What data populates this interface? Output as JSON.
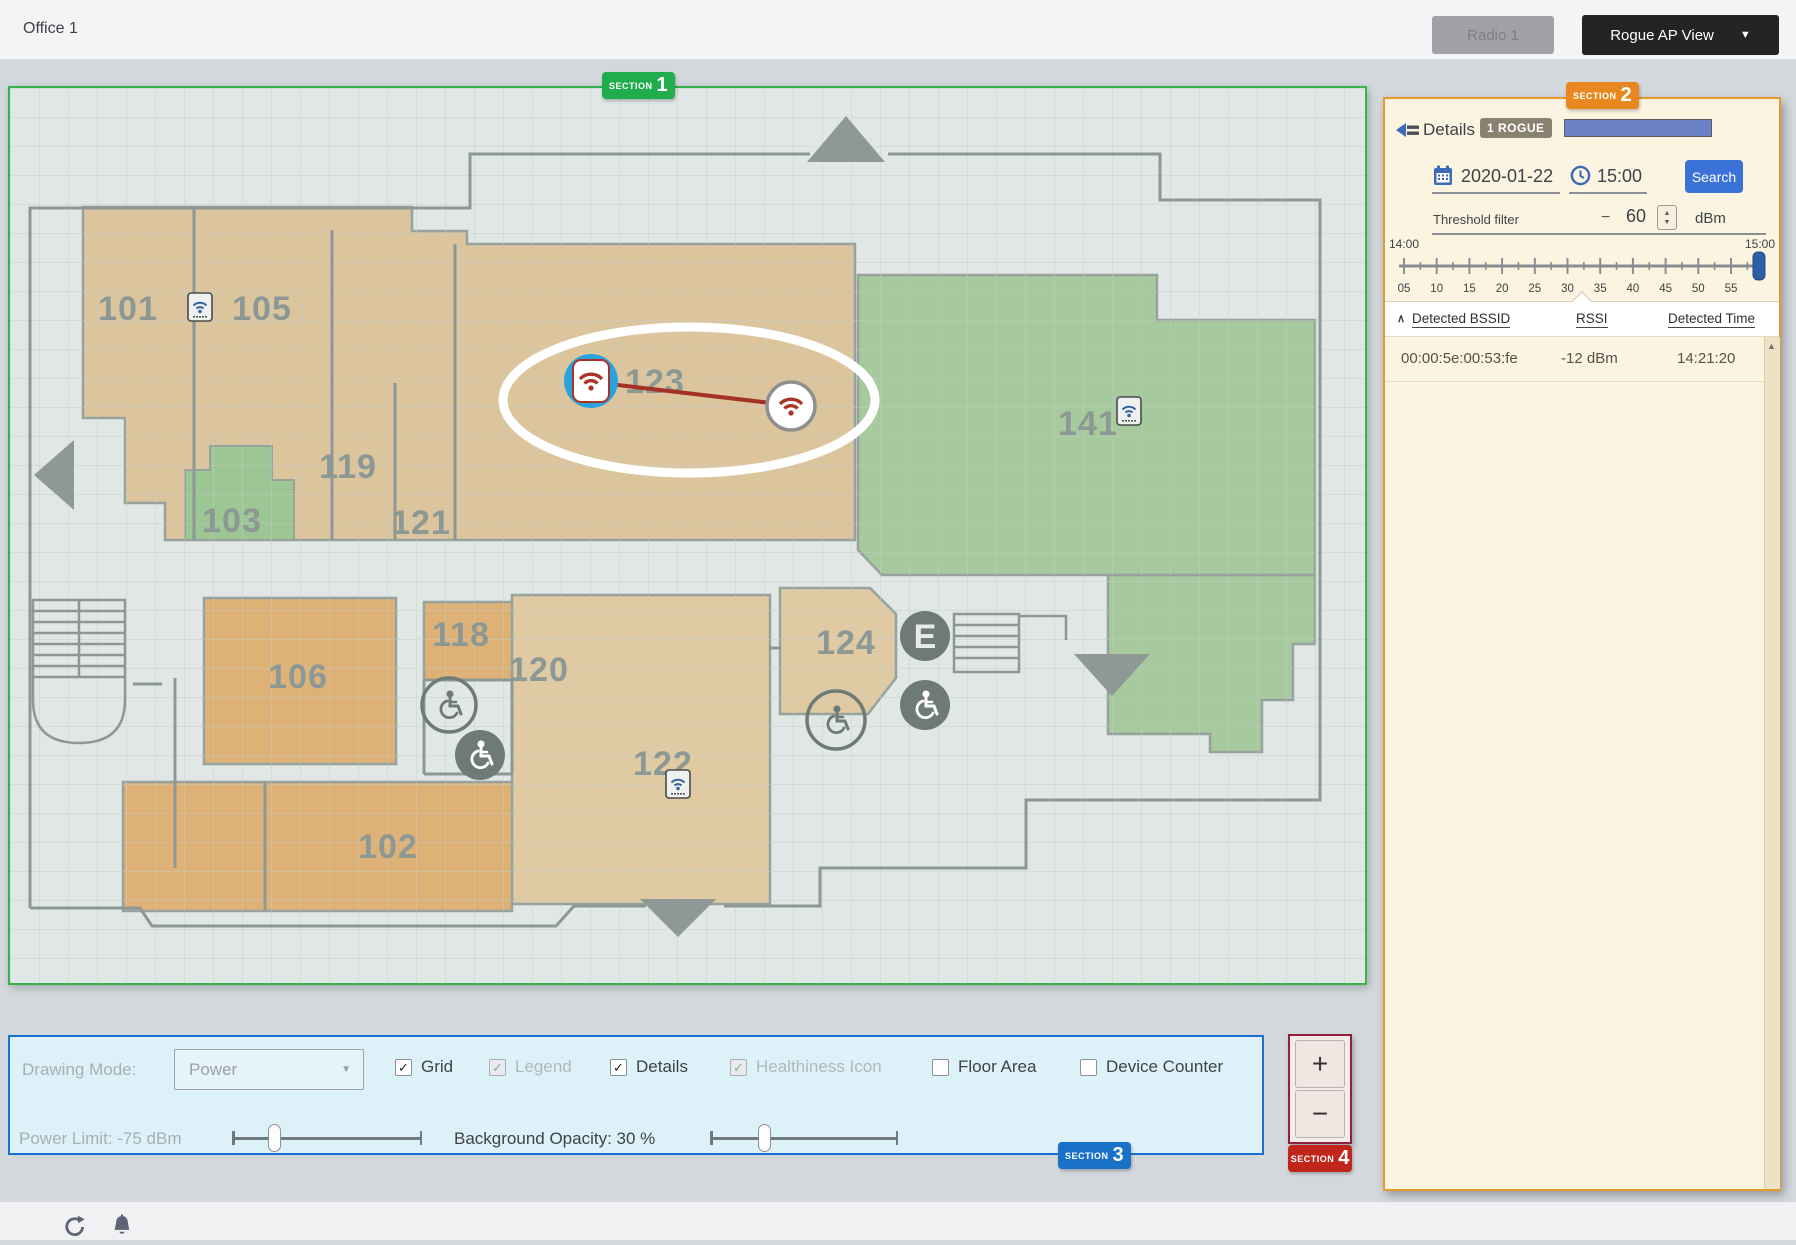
{
  "header": {
    "title": "Office 1",
    "radio_button": "Radio 1",
    "view_dropdown": "Rogue AP View",
    "dropdown_caret": "▼"
  },
  "sections": {
    "label": "SECTION",
    "s1": "1",
    "s2": "2",
    "s3": "3",
    "s4": "4"
  },
  "map": {
    "rooms": [
      {
        "label": "101",
        "x": 118,
        "y": 232
      },
      {
        "label": "105",
        "x": 252,
        "y": 232
      },
      {
        "label": "123",
        "x": 645,
        "y": 305
      },
      {
        "label": "141",
        "x": 1078,
        "y": 347
      },
      {
        "label": "119",
        "x": 338,
        "y": 390
      },
      {
        "label": "103",
        "x": 222,
        "y": 444
      },
      {
        "label": "121",
        "x": 411,
        "y": 446
      },
      {
        "label": "118",
        "x": 451,
        "y": 558
      },
      {
        "label": "120",
        "x": 529,
        "y": 593
      },
      {
        "label": "124",
        "x": 836,
        "y": 566
      },
      {
        "label": "106",
        "x": 288,
        "y": 600
      },
      {
        "label": "122",
        "x": 653,
        "y": 687
      },
      {
        "label": "102",
        "x": 378,
        "y": 770
      }
    ],
    "access_points": [
      {
        "x": 190,
        "y": 219
      },
      {
        "x": 1119,
        "y": 323
      },
      {
        "x": 668,
        "y": 696
      }
    ],
    "rogue_pair": {
      "ap_x": 581,
      "ap_y": 293,
      "rogue_x": 781,
      "rogue_y": 318,
      "ellipse": {
        "cx": 679,
        "cy": 312,
        "rx": 186,
        "ry": 73
      }
    },
    "icon_names": [
      "up-arrow",
      "left-arrow",
      "down-arrow",
      "elevator",
      "wheelchair",
      "stairs"
    ]
  },
  "panel": {
    "details_label": "Details",
    "rogue_badge": "1 ROGUE",
    "date": "2020-01-22",
    "time": "15:00",
    "search_label": "Search",
    "threshold_label": "Threshold filter",
    "threshold_minus": "−",
    "threshold_value": "60",
    "threshold_unit": "dBm",
    "timeline": {
      "start": "14:00",
      "end": "15:00",
      "ticks": [
        "05",
        "10",
        "15",
        "20",
        "25",
        "30",
        "35",
        "40",
        "45",
        "50",
        "55"
      ]
    },
    "table": {
      "sort_caret": "∧",
      "headers": [
        "Detected BSSID",
        "RSSI",
        "Detected Time"
      ],
      "rows": [
        [
          "00:00:5e:00:53:fe",
          "-12 dBm",
          "14:21:20"
        ]
      ]
    }
  },
  "controls": {
    "drawing_mode_label": "Drawing Mode:",
    "drawing_mode_value": "Power",
    "checkboxes": [
      {
        "label": "Grid",
        "checked": true,
        "disabled": false
      },
      {
        "label": "Legend",
        "checked": true,
        "disabled": true
      },
      {
        "label": "Details",
        "checked": true,
        "disabled": false
      },
      {
        "label": "Healthiness Icon",
        "checked": true,
        "disabled": true
      },
      {
        "label": "Floor Area",
        "checked": false,
        "disabled": false
      },
      {
        "label": "Device Counter",
        "checked": false,
        "disabled": false
      }
    ],
    "power_limit_label": "Power Limit: -75 dBm",
    "opacity_label": "Background Opacity: 30 %",
    "zoom_in": "+",
    "zoom_out": "−"
  },
  "colors": {
    "map_border": "#36b34b",
    "panel_border": "#e69a2e",
    "panel_bg": "#fbf4e1",
    "controls_border": "#1b6fd3",
    "controls_bg": "#ddf1f9",
    "search_button": "#3a72d8",
    "badge_section1": "#21ad4d",
    "badge_section2": "#e8871e",
    "badge_section3": "#1a72c8",
    "badge_section4": "#c1261d",
    "rogue_accent": "#a93326",
    "rogue_marker": "#2aa3dc",
    "room_orange": "#deb277",
    "room_tan": "#dcc59d",
    "room_light_tan": "#dfcaa3",
    "room_green": "#a6c99d"
  }
}
